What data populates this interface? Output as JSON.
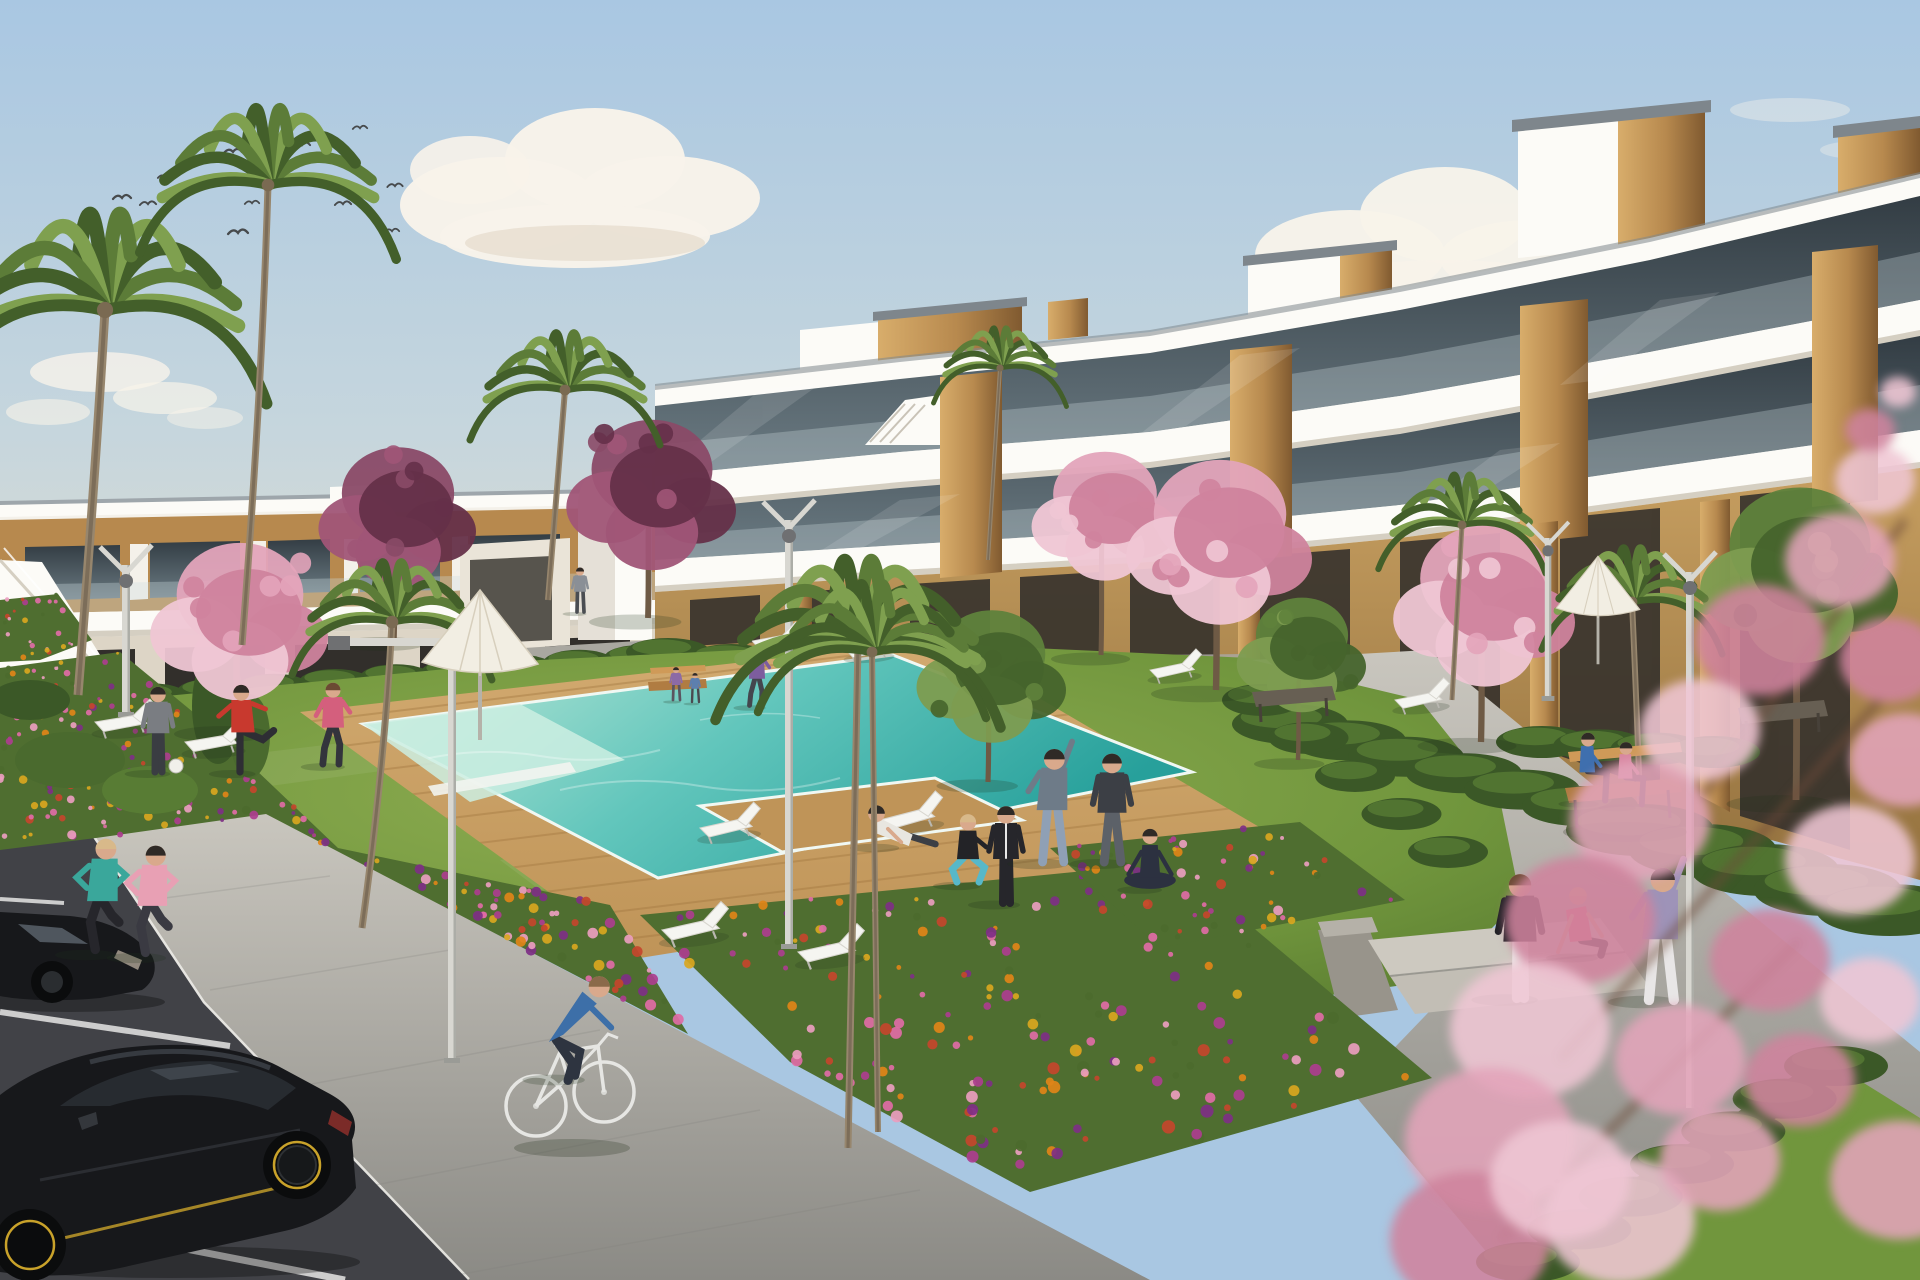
{
  "meta": {
    "description": "Sunny 3D architectural rendering: modern white apartment blocks with wood panel accents and glass balconies around a landscaped courtyard with swimming pool, wooden deck, sun loungers, parasols, flower beds, palm and cherry blossom trees, residents exercising on the lawn, two joggers, a cyclist and black cars in a parking area",
    "width": 1920,
    "height": 1280
  },
  "palette": {
    "sky_top": "#a9c7e2",
    "sky_mid": "#c6d6dd",
    "sky_low": "#e9dfcd",
    "cloud": "#f8f3ea",
    "cloud_shade": "#ded2c0",
    "bird": "#474a4c",
    "wall": "#f4f1ea",
    "slab": "#fcfbf7",
    "slab_shade": "#d5cfc2",
    "edge_dark": "#7e868c",
    "glass_top": "#333d44",
    "glass_bot": "#6b7b83",
    "rail": "#cfdde2",
    "wood_hi": "#d8ad6b",
    "wood": "#b7894e",
    "wood_dk": "#805a30",
    "tan": "#c69e60",
    "tan_dk": "#93713e",
    "opening": "#322f2b",
    "lawn_hi": "#8fae52",
    "lawn": "#71963d",
    "lawn_dk": "#55772e",
    "hedge": "#3b5827",
    "hedge_hi": "#587c34",
    "bush": "#4a6a2e",
    "deck_hi": "#d2aa70",
    "deck": "#bf9458",
    "deck_ln": "#a1763f",
    "pool_hi": "#c2ead9",
    "pool": "#62c6bc",
    "pool_dk": "#27a09b",
    "coping": "#f0f8f3",
    "path_hi": "#c9c6be",
    "path": "#a9a7a0",
    "path_dk": "#8b8a85",
    "curb": "#ebeae5",
    "asphalt": "#414247",
    "asphalt_dk": "#36373b",
    "line": "#dddddc",
    "trunk": "#6e5a45",
    "palm_trunk": "#97866d",
    "palm_hi": "#7fa04f",
    "palm": "#5c7c38",
    "palm_dk": "#435f2a",
    "blossom_hi": "#efc6d4",
    "blossom": "#e3a4ba",
    "blossom_dk": "#cf839d",
    "plum_hi": "#a05577",
    "plum": "#8a4a67",
    "plum_dk": "#653049",
    "green_hi": "#7d9c50",
    "green": "#5f823c",
    "green_dk": "#46642c",
    "lamp": "#d8d7d1",
    "lamp_dk": "#9a9b96",
    "lamp_head": "#6f7072",
    "bench_wood": "#b07c42",
    "bench_wood_hi": "#cf9a58",
    "bench_metal": "#474139",
    "bench_gray": "#675f53",
    "car": "#17181b",
    "car_hi": "#34373c",
    "car_win": "#272b30",
    "car_win_hi": "#555d66",
    "rim": "#c9a22a",
    "tail": "#8d2f2a",
    "parasol": "#f2eee3",
    "parasol_dk": "#d7cfbd",
    "shadow": "#22301c",
    "skin": "#d9a98c",
    "white": "#f2f2ee",
    "teal_reflect": "#5fb8ac"
  },
  "clouds": [
    {
      "cx": 100,
      "cy": 372,
      "rx": 70,
      "ry": 20,
      "o": 0.8
    },
    {
      "cx": 165,
      "cy": 398,
      "rx": 52,
      "ry": 16,
      "o": 0.7
    },
    {
      "cx": 48,
      "cy": 412,
      "rx": 42,
      "ry": 13,
      "o": 0.6
    },
    {
      "cx": 205,
      "cy": 418,
      "rx": 38,
      "ry": 11,
      "o": 0.5
    },
    {
      "cx": 500,
      "cy": 205,
      "rx": 100,
      "ry": 48,
      "o": 0.97
    },
    {
      "cx": 595,
      "cy": 160,
      "rx": 90,
      "ry": 52,
      "o": 0.97
    },
    {
      "cx": 668,
      "cy": 198,
      "rx": 92,
      "ry": 42,
      "o": 0.97
    },
    {
      "cx": 575,
      "cy": 236,
      "rx": 135,
      "ry": 32,
      "o": 0.97
    },
    {
      "cx": 470,
      "cy": 170,
      "rx": 60,
      "ry": 34,
      "o": 0.9
    },
    {
      "cx": 585,
      "cy": 243,
      "rx": 120,
      "ry": 18,
      "o": 0.5,
      "c": "cloud_shade"
    },
    {
      "cx": 940,
      "cy": 395,
      "rx": 85,
      "ry": 12,
      "o": 0.5
    },
    {
      "cx": 1065,
      "cy": 425,
      "rx": 120,
      "ry": 13,
      "o": 0.55
    },
    {
      "cx": 1190,
      "cy": 455,
      "rx": 90,
      "ry": 10,
      "o": 0.45
    },
    {
      "cx": 860,
      "cy": 440,
      "rx": 70,
      "ry": 9,
      "o": 0.4
    },
    {
      "cx": 1350,
      "cy": 255,
      "rx": 95,
      "ry": 45,
      "o": 0.95
    },
    {
      "cx": 1445,
      "cy": 215,
      "rx": 85,
      "ry": 48,
      "o": 0.95
    },
    {
      "cx": 1530,
      "cy": 258,
      "rx": 90,
      "ry": 38,
      "o": 0.95
    },
    {
      "cx": 1610,
      "cy": 230,
      "rx": 60,
      "ry": 30,
      "o": 0.85
    },
    {
      "cx": 1445,
      "cy": 285,
      "rx": 130,
      "ry": 25,
      "o": 0.9
    },
    {
      "cx": 1790,
      "cy": 110,
      "rx": 60,
      "ry": 12,
      "o": 0.4
    },
    {
      "cx": 1860,
      "cy": 150,
      "rx": 40,
      "ry": 9,
      "o": 0.35
    }
  ],
  "birds": [
    [
      122,
      199,
      1
    ],
    [
      148,
      205,
      0.9
    ],
    [
      165,
      178,
      0.8
    ],
    [
      233,
      153,
      1
    ],
    [
      302,
      146,
      0.9
    ],
    [
      238,
      234,
      1.1
    ],
    [
      252,
      204,
      0.8
    ],
    [
      343,
      205,
      0.9
    ],
    [
      360,
      129,
      0.8
    ],
    [
      395,
      187,
      0.85
    ],
    [
      392,
      232,
      0.8
    ]
  ],
  "palms": [
    {
      "cx": 105,
      "cy": 310,
      "L": 170,
      "trunk": [
        [
          78,
          695
        ],
        [
          95,
          480
        ]
      ],
      "w": 9
    },
    {
      "cx": 268,
      "cy": 185,
      "L": 135,
      "trunk": [
        [
          242,
          645
        ],
        [
          262,
          390
        ]
      ],
      "w": 7
    },
    {
      "cx": 392,
      "cy": 622,
      "L": 105,
      "trunk": [
        [
          362,
          928
        ],
        [
          385,
          760
        ]
      ],
      "w": 7
    },
    {
      "cx": 565,
      "cy": 390,
      "L": 100,
      "trunk": [
        [
          548,
          600
        ],
        [
          558,
          480
        ]
      ],
      "w": 6
    },
    {
      "cx": 1000,
      "cy": 368,
      "L": 70,
      "trunk": [
        [
          988,
          560
        ],
        [
          995,
          450
        ]
      ],
      "w": 4
    },
    {
      "cx": 1462,
      "cy": 525,
      "L": 88,
      "trunk": [
        [
          1452,
          700
        ],
        [
          1458,
          600
        ]
      ],
      "w": 5
    },
    {
      "cx": 1632,
      "cy": 602,
      "L": 95,
      "trunk": [
        [
          1640,
          800
        ],
        [
          1636,
          690
        ]
      ],
      "w": 6
    }
  ],
  "palm_foreground": [
    {
      "cx": 858,
      "cy": 645,
      "L": 150,
      "trunk": [
        [
          848,
          1148
        ],
        [
          853,
          880
        ]
      ],
      "w": 7
    },
    {
      "cx": 872,
      "cy": 652,
      "L": 120,
      "trunk": [
        [
          878,
          1132
        ],
        [
          874,
          880
        ]
      ],
      "w": 6
    }
  ],
  "trees": [
    {
      "kind": "cherry",
      "cx": 240,
      "cy": 608,
      "r": 88,
      "base": 730
    },
    {
      "kind": "plum",
      "cx": 398,
      "cy": 505,
      "r": 78,
      "base": 640
    },
    {
      "kind": "plum",
      "cx": 652,
      "cy": 482,
      "r": 84,
      "base": 618
    },
    {
      "kind": "cherry",
      "cx": 1105,
      "cy": 505,
      "r": 72,
      "base": 655
    },
    {
      "kind": "cherry",
      "cx": 1220,
      "cy": 528,
      "r": 92,
      "base": 690
    },
    {
      "kind": "cherry",
      "cx": 1485,
      "cy": 592,
      "r": 90,
      "base": 742
    },
    {
      "kind": "green",
      "cx": 992,
      "cy": 665,
      "r": 74,
      "base": 782
    },
    {
      "kind": "green",
      "cx": 1302,
      "cy": 645,
      "r": 64,
      "base": 760
    },
    {
      "kind": "green",
      "cx": 1800,
      "cy": 560,
      "r": 98,
      "base": 800
    }
  ],
  "flower_beds": [
    {
      "name": "bed-left",
      "seed": 7,
      "count": 235,
      "poly": [
        [
          0,
          668
        ],
        [
          120,
          652
        ],
        [
          210,
          726
        ],
        [
          338,
          848
        ],
        [
          610,
          905
        ],
        [
          688,
          1034
        ],
        [
          266,
          814
        ],
        [
          96,
          838
        ],
        [
          0,
          850
        ]
      ]
    },
    {
      "name": "bed-center",
      "seed": 11,
      "count": 175,
      "poly": [
        [
          640,
          915
        ],
        [
          1175,
          862
        ],
        [
          1432,
          1078
        ],
        [
          1030,
          1192
        ],
        [
          790,
          1062
        ]
      ]
    },
    {
      "name": "bed-right",
      "seed": 13,
      "count": 60,
      "poly": [
        [
          1050,
          848
        ],
        [
          1300,
          822
        ],
        [
          1405,
          900
        ],
        [
          1160,
          948
        ]
      ]
    },
    {
      "name": "bed-edge",
      "seed": 5,
      "count": 26,
      "poly": [
        [
          0,
          600
        ],
        [
          58,
          594
        ],
        [
          92,
          640
        ],
        [
          40,
          660
        ],
        [
          0,
          662
        ]
      ]
    }
  ],
  "flower_colors": [
    "#e08418",
    "#d9a61f",
    "#e06ba6",
    "#ad3d8f",
    "#7e2f86",
    "#ea9dbf",
    "#c4452c",
    "#4c6a2e"
  ],
  "hedge_chains": [
    {
      "from": [
        30,
        706
      ],
      "to": [
        640,
        658
      ],
      "n": 11,
      "rx": 36,
      "ry": 13
    },
    {
      "from": [
        668,
        652
      ],
      "to": [
        1240,
        706
      ],
      "n": 10,
      "rx": 42,
      "ry": 14
    },
    {
      "from": [
        1290,
        724
      ],
      "to": [
        1580,
        806
      ],
      "n": 6,
      "rx": 58,
      "ry": 20
    },
    {
      "from": [
        1640,
        830
      ],
      "to": [
        1890,
        910
      ],
      "n": 5,
      "rx": 74,
      "ry": 26
    },
    {
      "from": [
        1262,
        700
      ],
      "to": [
        1448,
        852
      ],
      "n": 5,
      "rx": 40,
      "ry": 16
    },
    {
      "from": [
        1528,
        1262
      ],
      "to": [
        1836,
        1066
      ],
      "n": 7,
      "rx": 52,
      "ry": 20
    },
    {
      "from": [
        1542,
        742
      ],
      "to": [
        1714,
        752
      ],
      "n": 4,
      "rx": 46,
      "ry": 16
    }
  ],
  "loungers": [
    [
      95,
      722,
      -3,
      1
    ],
    [
      185,
      742,
      -3,
      1
    ],
    [
      752,
      641,
      -4,
      0.8
    ],
    [
      846,
      650,
      -4,
      0.8
    ],
    [
      1150,
      670,
      -5,
      0.85
    ],
    [
      1395,
      700,
      -5,
      0.9
    ],
    [
      700,
      828,
      -6,
      1
    ],
    [
      880,
      820,
      -8,
      1.05
    ],
    [
      662,
      930,
      -6,
      1.1
    ],
    [
      798,
      952,
      -6,
      1.1
    ]
  ],
  "parasols": [
    [
      480,
      598,
      1
    ],
    [
      1598,
      562,
      0.72
    ]
  ],
  "lamps": [
    {
      "type": "L",
      "x": 452,
      "top": 648,
      "base": 1062
    },
    {
      "type": "V",
      "x": 789,
      "top": 520,
      "base": 948
    },
    {
      "type": "V",
      "x": 1690,
      "top": 572,
      "base": 1112
    },
    {
      "type": "V",
      "x": 126,
      "top": 565,
      "base": 716
    },
    {
      "type": "V",
      "x": 1548,
      "top": 538,
      "base": 700,
      "s": 0.8
    }
  ],
  "people": [
    {
      "id": "man-gray-ball",
      "pose": "stand",
      "x": 158,
      "y": 772,
      "h": 88,
      "top": "#7a7d82",
      "bottom": "#3a3d42",
      "hair": "#2f2a26"
    },
    {
      "id": "man-red-kicking",
      "pose": "kick",
      "x": 243,
      "y": 772,
      "h": 90,
      "top": "#c8392e",
      "bottom": "#2e2e34",
      "hair": "#2f2a26"
    },
    {
      "id": "woman-pink-walking",
      "pose": "walk",
      "x": 333,
      "y": 765,
      "h": 85,
      "top": "#d45f7d",
      "bottom": "#33343c",
      "hair": "#6b4a33"
    },
    {
      "id": "jogger-teal",
      "pose": "jog",
      "x": 100,
      "y": 953,
      "h": 118,
      "top": "#3aa79b",
      "bottom": "#26262b",
      "hair": "#d8b98a"
    },
    {
      "id": "jogger-pink",
      "pose": "jog",
      "x": 150,
      "y": 956,
      "h": 114,
      "top": "#e8a0b4",
      "bottom": "#3a3a42",
      "hair": "#2f2a26"
    },
    {
      "id": "cyclist",
      "pose": "cycle",
      "x": 568,
      "y": 1078,
      "h": 120,
      "top": "#3d6fa8",
      "bottom": "#2e3440",
      "hair": "#8a6a4a"
    },
    {
      "id": "man-reclining",
      "pose": "recline",
      "x": 886,
      "y": 846,
      "h": 95,
      "top": "#e8e6e0",
      "bottom": "#3c3f45",
      "hair": "#2f2a26"
    },
    {
      "id": "woman-squat-teal",
      "pose": "squat",
      "x": 968,
      "y": 884,
      "h": 92,
      "top": "#232327",
      "bottom": "#57b8c9",
      "hair": "#d8b98a"
    },
    {
      "id": "person-tracksuit",
      "pose": "back",
      "x": 1006,
      "y": 903,
      "h": 100,
      "top": "#26262b",
      "bottom": "#26262b",
      "stripe": "#e8e8e8",
      "hair": "#2f2a26"
    },
    {
      "id": "man-stretching",
      "pose": "stretch",
      "x": 1052,
      "y": 862,
      "h": 118,
      "top": "#6e7b88",
      "bottom": "#8fa0b5",
      "hair": "#2f2a26"
    },
    {
      "id": "man-shorts",
      "pose": "wide",
      "x": 1112,
      "y": 862,
      "h": 112,
      "top": "#3c3f45",
      "bottom": "#5c6168",
      "hair": "#2f2a26"
    },
    {
      "id": "person-crosslegged",
      "pose": "cross",
      "x": 1150,
      "y": 888,
      "h": 86,
      "top": "#2c3140",
      "bottom": "#2c3140",
      "hair": "#2f2a26"
    },
    {
      "id": "woman-standing-steps",
      "pose": "back",
      "x": 1520,
      "y": 998,
      "h": 128,
      "top": "#1f1f24",
      "bottom": "#eceae8",
      "hair": "#6b4a33"
    },
    {
      "id": "woman-sitting-steps",
      "pose": "sitground",
      "x": 1584,
      "y": 956,
      "h": 100,
      "top": "#e2647e",
      "bottom": "#26262b",
      "hair": "#d8b98a"
    },
    {
      "id": "woman-stretching-steps",
      "pose": "stretch",
      "x": 1660,
      "y": 1000,
      "h": 138,
      "top": "#9e93b8",
      "bottom": "#e8e6e6",
      "hair": "#2f2a26"
    },
    {
      "id": "man-bench",
      "pose": "sitbench",
      "x": 1588,
      "y": 802,
      "h": 78,
      "top": "#3f6fae",
      "bottom": "#33343a",
      "hair": "#2f2a26"
    },
    {
      "id": "woman-bench",
      "pose": "sitbench",
      "x": 1626,
      "y": 806,
      "h": 72,
      "top": "#d886a0",
      "bottom": "#3a3640",
      "hair": "#2f2a26"
    },
    {
      "id": "walker-back-path",
      "pose": "walk",
      "x": 757,
      "y": 706,
      "h": 62,
      "top": "#7d5d9e",
      "bottom": "#44464e",
      "hair": "#2f2a26"
    },
    {
      "id": "person-doorway",
      "pose": "stand",
      "x": 580,
      "y": 612,
      "h": 46,
      "top": "#8a8f96",
      "bottom": "#4a4d52",
      "hair": "#2f2a26"
    },
    {
      "id": "child-1",
      "pose": "stand",
      "x": 676,
      "y": 700,
      "h": 34,
      "top": "#8c6aa6",
      "bottom": "#5a5560",
      "hair": "#2f2a26"
    },
    {
      "id": "child-2",
      "pose": "stand",
      "x": 695,
      "y": 702,
      "h": 30,
      "top": "#5d7fae",
      "bottom": "#4a4a50",
      "hair": "#2f2a26"
    }
  ],
  "blossom_foreground": {
    "blobs": [
      [
        1875,
        480,
        40
      ],
      [
        1840,
        560,
        55
      ],
      [
        1760,
        640,
        65
      ],
      [
        1700,
        730,
        60
      ],
      [
        1640,
        820,
        70
      ],
      [
        1580,
        920,
        75
      ],
      [
        1530,
        1030,
        80
      ],
      [
        1490,
        1140,
        85
      ],
      [
        1470,
        1240,
        80
      ],
      [
        1560,
        1180,
        70
      ],
      [
        1680,
        1060,
        65
      ],
      [
        1770,
        960,
        60
      ],
      [
        1850,
        860,
        65
      ],
      [
        1905,
        760,
        55
      ],
      [
        1890,
        660,
        50
      ],
      [
        1620,
        1220,
        75
      ],
      [
        1720,
        1160,
        60
      ],
      [
        1800,
        1080,
        55
      ],
      [
        1870,
        1000,
        50
      ],
      [
        1900,
        1180,
        70
      ],
      [
        1870,
        430,
        25
      ],
      [
        1898,
        392,
        18
      ]
    ],
    "branches": [
      [
        [
          1905,
          520
        ],
        [
          1700,
          800
        ]
      ],
      [
        [
          1880,
          700
        ],
        [
          1560,
          1060
        ]
      ],
      [
        [
          1800,
          940
        ],
        [
          1500,
          1240
        ]
      ]
    ]
  }
}
